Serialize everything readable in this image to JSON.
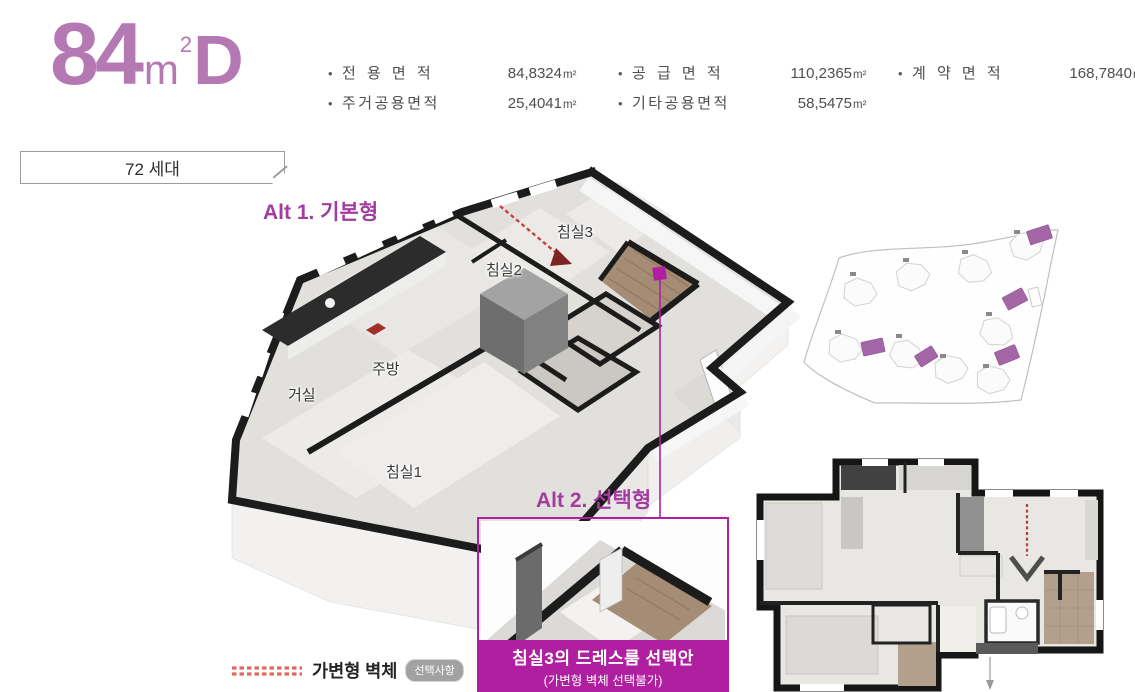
{
  "title": {
    "size": "84",
    "unit": "m",
    "sup": "2",
    "variant": "D"
  },
  "area_specs": {
    "bullet": "•",
    "items": [
      {
        "label": "전 용 면 적",
        "value": "84,8324",
        "unit": "m²"
      },
      {
        "label": "공 급 면 적",
        "value": "110,2365",
        "unit": "m²"
      },
      {
        "label": "계 약 면 적",
        "value": "168,7840",
        "unit": "m²"
      },
      {
        "label": "주거공용면적",
        "value": "25,4041",
        "unit": "m²"
      },
      {
        "label": "기타공용면적",
        "value": "58,5475",
        "unit": "m²"
      }
    ]
  },
  "units_badge": {
    "label": "72 세대"
  },
  "plan3d": {
    "alt1_label": "Alt 1. 기본형",
    "rooms": {
      "bed3": "침실3",
      "bed2": "침실2",
      "kitchen": "주방",
      "living": "거실",
      "bed1": "침실1"
    }
  },
  "alt2": {
    "label": "Alt 2. 선택형",
    "caption_title": "침실3의 드레스룸 선택안",
    "caption_note": "(가변형 벽체 선택불가)"
  },
  "legend": {
    "label": "가변형 벽체",
    "badge": "선택사항"
  },
  "colors": {
    "accent_purple": "#b478b2",
    "accent_magenta": "#a33c9e",
    "strong_magenta": "#b01f9f",
    "dash_red": "#c2453e",
    "dressroom_tan": "#a58c74",
    "wall_black": "#1c1c1c"
  }
}
